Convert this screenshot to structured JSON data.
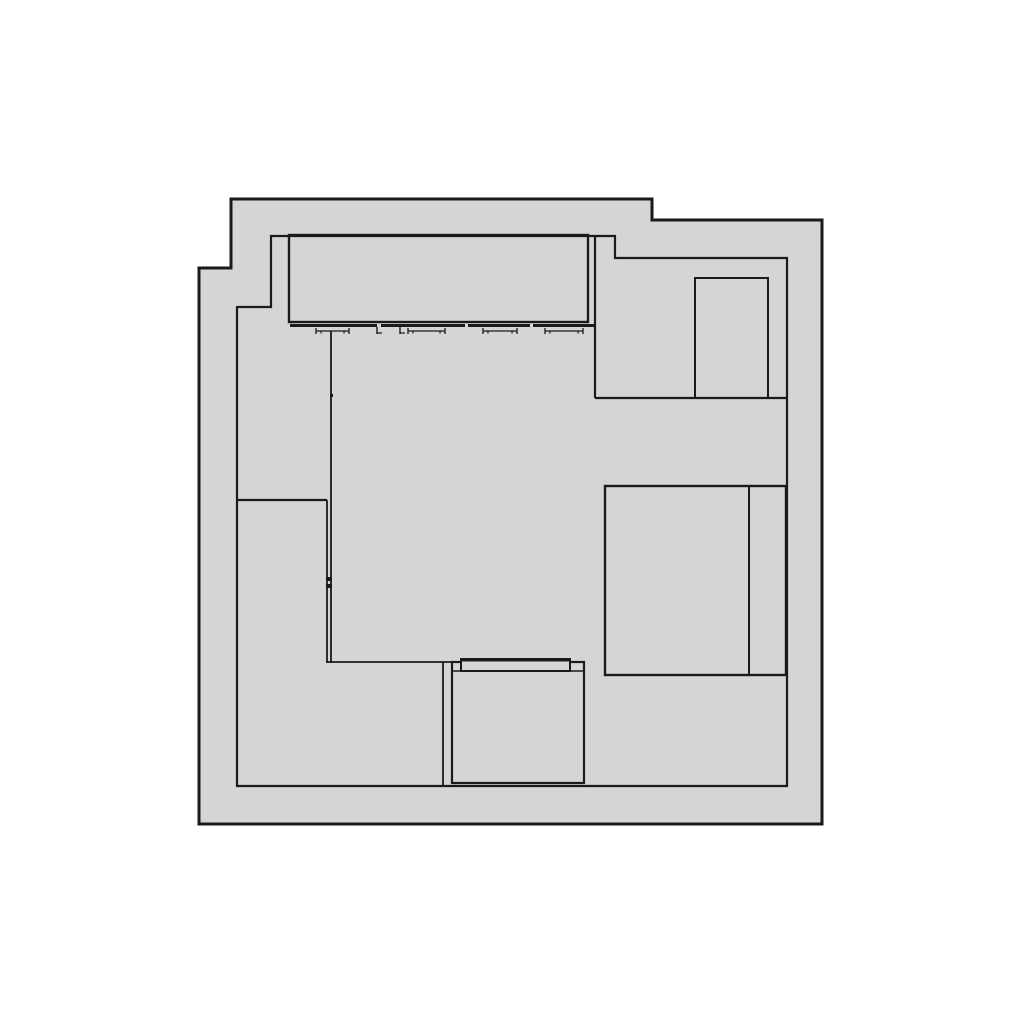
{
  "plan": {
    "label": "floor-plan-drawing",
    "canvas": {
      "width": 1024,
      "height": 1024,
      "background": "#ffffff"
    },
    "colors": {
      "room_fill": "#d5d5d5",
      "line": "#1a1a1a"
    },
    "outer_boundary": {
      "stroke_width": 3,
      "points": [
        [
          231,
          199
        ],
        [
          652,
          199
        ],
        [
          652,
          220
        ],
        [
          822,
          220
        ],
        [
          822,
          824
        ],
        [
          199,
          824
        ],
        [
          199,
          268
        ],
        [
          231,
          268
        ]
      ]
    },
    "inner_boundary": {
      "stroke_width": 2.2,
      "points": [
        [
          271,
          236
        ],
        [
          615,
          236
        ],
        [
          615,
          258
        ],
        [
          787,
          258
        ],
        [
          787,
          786
        ],
        [
          237,
          786
        ],
        [
          237,
          307
        ],
        [
          271,
          307
        ]
      ]
    },
    "walls": [
      {
        "name": "wall-right-room-left",
        "x1": 595,
        "y1": 236,
        "x2": 595,
        "y2": 398,
        "w": 2.2
      },
      {
        "name": "wall-right-room-bottom",
        "x1": 595,
        "y1": 398,
        "x2": 787,
        "y2": 398,
        "w": 2.2
      },
      {
        "name": "wall-left-step",
        "x1": 237,
        "y1": 500,
        "x2": 327,
        "y2": 500,
        "w": 2.2
      },
      {
        "name": "wall-left-inner-front",
        "x1": 327,
        "y1": 500,
        "x2": 327,
        "y2": 663,
        "w": 1.8
      },
      {
        "name": "wall-left-inner-back",
        "x1": 331,
        "y1": 331,
        "x2": 331,
        "y2": 663,
        "w": 1.8
      },
      {
        "name": "wall-bottom-step",
        "x1": 327,
        "y1": 662,
        "x2": 452,
        "y2": 662,
        "w": 1.8
      },
      {
        "name": "wall-bottom-return",
        "x1": 443,
        "y1": 662,
        "x2": 443,
        "y2": 786,
        "w": 1.8
      }
    ],
    "wall_ticks": [
      {
        "name": "wall-joint-tick",
        "x": 326,
        "y": 577,
        "w": 6,
        "h": 4
      },
      {
        "name": "wall-joint-tick",
        "x": 326,
        "y": 584,
        "w": 6,
        "h": 4
      },
      {
        "name": "wall-stub-tick",
        "x": 330,
        "y": 394,
        "w": 3,
        "h": 3
      }
    ],
    "furniture": {
      "wardrobe": {
        "x": 289,
        "y": 235,
        "w": 299,
        "h": 87,
        "stroke": 2.4
      },
      "wardrobe_rail": {
        "y": 325.5,
        "thickness": 3,
        "segments": [
          [
            290,
            377
          ],
          [
            381,
            465
          ],
          [
            468,
            530
          ],
          [
            533,
            596
          ]
        ]
      },
      "hanger_glyphs": [
        {
          "a": 316,
          "b": 349
        },
        {
          "a": 408,
          "b": 445
        },
        {
          "a": 483,
          "b": 517
        },
        {
          "a": 545,
          "b": 583
        }
      ],
      "hanger_ticks": [
        {
          "x": 377
        },
        {
          "x": 400
        }
      ],
      "cabinet_top_right": {
        "x": 695,
        "y": 278,
        "w": 73,
        "h": 120,
        "stroke": 2
      },
      "bed": {
        "x": 605,
        "y": 486,
        "w": 181,
        "h": 189,
        "stroke": 2.4,
        "divider_x": 749,
        "divider_w": 2
      },
      "dresser": {
        "x": 452,
        "y": 662,
        "w": 132,
        "h": 121,
        "stroke": 2.2,
        "shelf_y": 671,
        "shelf_w": 1.6,
        "band": {
          "x": 461,
          "y": 659,
          "w": 109,
          "h": 12,
          "stroke": 2,
          "top_thick": 3
        }
      }
    }
  }
}
